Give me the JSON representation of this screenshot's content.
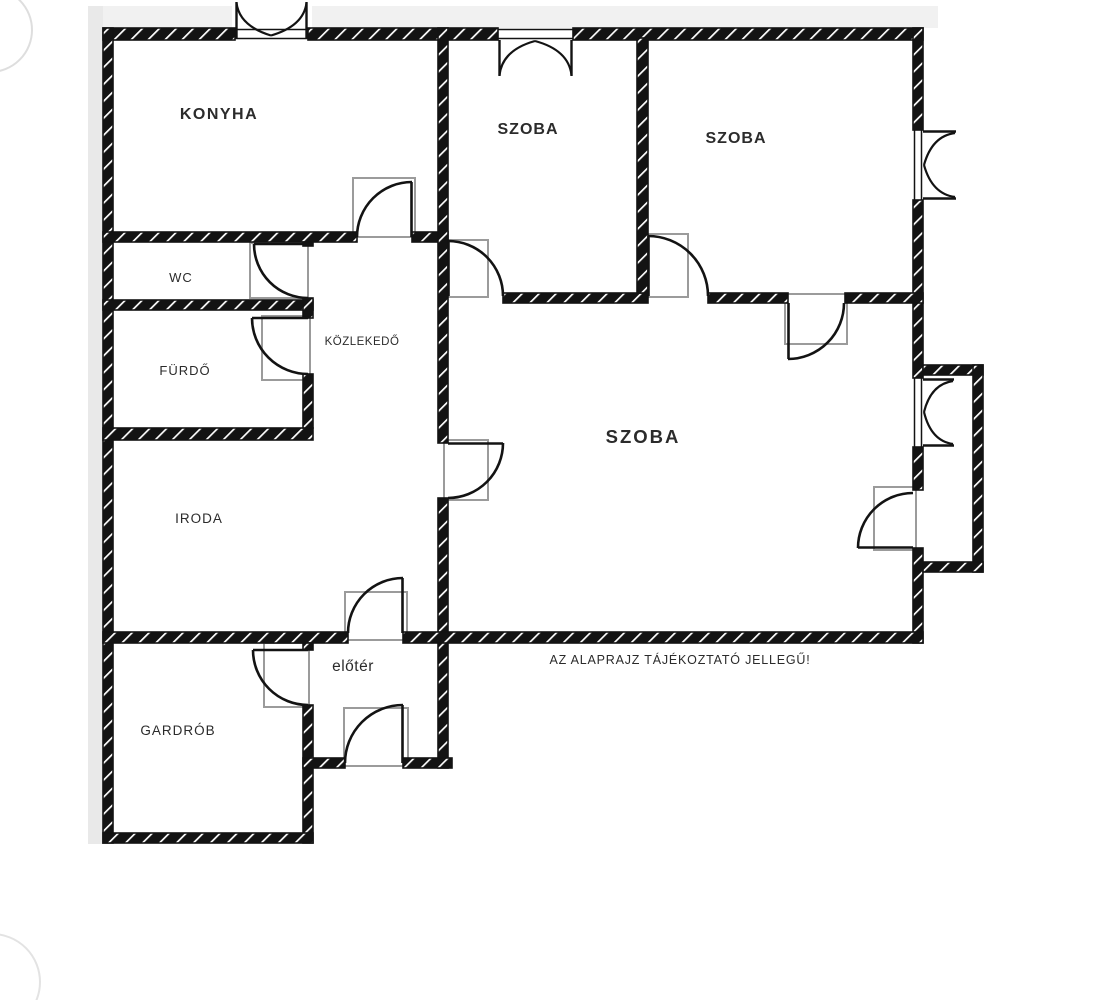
{
  "title": "Alaprajz",
  "rooms": {
    "konyha": {
      "label": "KONYHA"
    },
    "szoba_top_mid": {
      "label": "SZOBA"
    },
    "szoba_top_right": {
      "label": "SZOBA"
    },
    "wc": {
      "label": "WC"
    },
    "furdo": {
      "label": "FÜRDŐ"
    },
    "kozlekedo": {
      "label": "KÖZLEKEDŐ"
    },
    "szoba_nagy": {
      "label": "SZOBA"
    },
    "iroda": {
      "label": "IRODA"
    },
    "eloter": {
      "label": "előtér"
    },
    "gardrob": {
      "label": "GARDRÓB"
    }
  },
  "disclaimer": "AZ ALAPRAJZ TÁJÉKOZTATÓ JELLEGŰ!",
  "colors": {
    "wall": "#131313",
    "door_frame": "#9b9b9b",
    "background": "#ffffff",
    "label": "#2b2b2b"
  }
}
